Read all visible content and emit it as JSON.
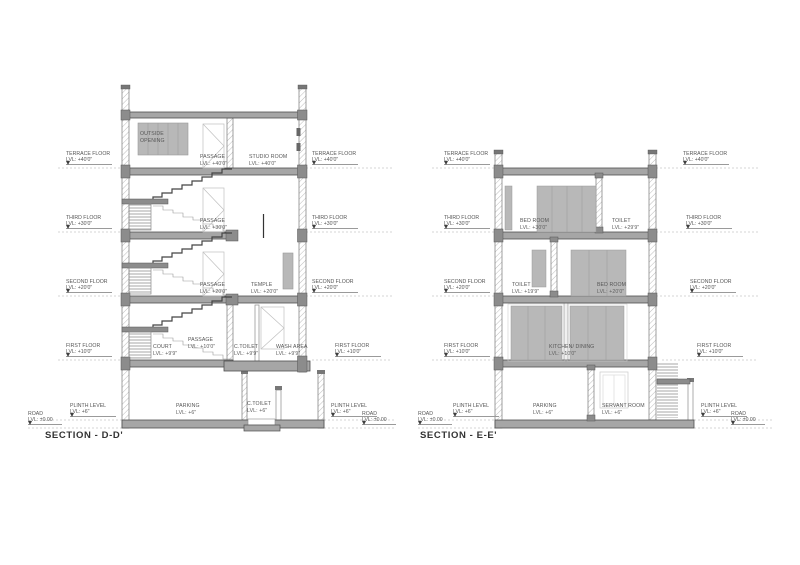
{
  "drawing": {
    "type": "architectural building sections",
    "background": "#ffffff",
    "colors": {
      "line": "#4a4a4a",
      "slab": "#a6a6a6",
      "wall_hatch": "#bcbcbc",
      "furniture": "#b8b8b8",
      "text": "#565656",
      "leader_dash": "#c6c6c6"
    }
  },
  "levels": {
    "terrace": {
      "name": "TERRACE FLOOR",
      "lvl": "LVL: +40'0\""
    },
    "third": {
      "name": "THIRD FLOOR",
      "lvl": "LVL: +30'0\""
    },
    "second": {
      "name": "SECOND FLOOR",
      "lvl": "LVL: +20'0\""
    },
    "first": {
      "name": "FIRST FLOOR",
      "lvl": "LVL: +10'0\""
    },
    "plinth": {
      "name": "PLINTH LEVEL",
      "lvl": "LVL: +6\""
    },
    "road": {
      "name": "ROAD",
      "lvl": "LVL: ±0.00"
    }
  },
  "sections": {
    "dd": {
      "title": "SECTION - D-D'",
      "rooms": {
        "outside_opening": {
          "name": "OUTSIDE OPENING",
          "lvl": ""
        },
        "passage_t": {
          "name": "PASSAGE",
          "lvl": "LVL: +40'0\""
        },
        "studio": {
          "name": "STUDIO ROOM",
          "lvl": "LVL: +40'0\""
        },
        "passage_3": {
          "name": "PASSAGE",
          "lvl": "LVL: +30'0\""
        },
        "passage_2": {
          "name": "PASSAGE",
          "lvl": "LVL: +20'0\""
        },
        "temple": {
          "name": "TEMPLE",
          "lvl": "LVL: +20'0\""
        },
        "court": {
          "name": "COURT",
          "lvl": "LVL: +9'9\""
        },
        "passage_1": {
          "name": "PASSAGE",
          "lvl": "LVL: +10'0\""
        },
        "ctoilet_1": {
          "name": "C.TOILET",
          "lvl": "LVL: +9'9\""
        },
        "wash": {
          "name": "WASH AREA",
          "lvl": "LVL: +9'9\""
        },
        "parking": {
          "name": "PARKING",
          "lvl": "LVL: +6\""
        },
        "ctoilet_g": {
          "name": "C.TOILET",
          "lvl": "LVL: +6\""
        }
      }
    },
    "ee": {
      "title": "SECTION - E-E'",
      "rooms": {
        "bed_3": {
          "name": "BED ROOM",
          "lvl": "LVL: +30'0\""
        },
        "toilet_3": {
          "name": "TOILET",
          "lvl": "LVL: +29'9\""
        },
        "toilet_2": {
          "name": "TOILET",
          "lvl": "LVL: +19'9\""
        },
        "bed_2": {
          "name": "BED ROOM",
          "lvl": "LVL: +20'0\""
        },
        "kitchen": {
          "name": "KITCHEN/ DINING",
          "lvl": "LVL: +10'0\""
        },
        "parking": {
          "name": "PARKING",
          "lvl": "LVL: +6\""
        },
        "servant": {
          "name": "SERVANT ROOM",
          "lvl": "LVL: +6\""
        }
      }
    }
  }
}
